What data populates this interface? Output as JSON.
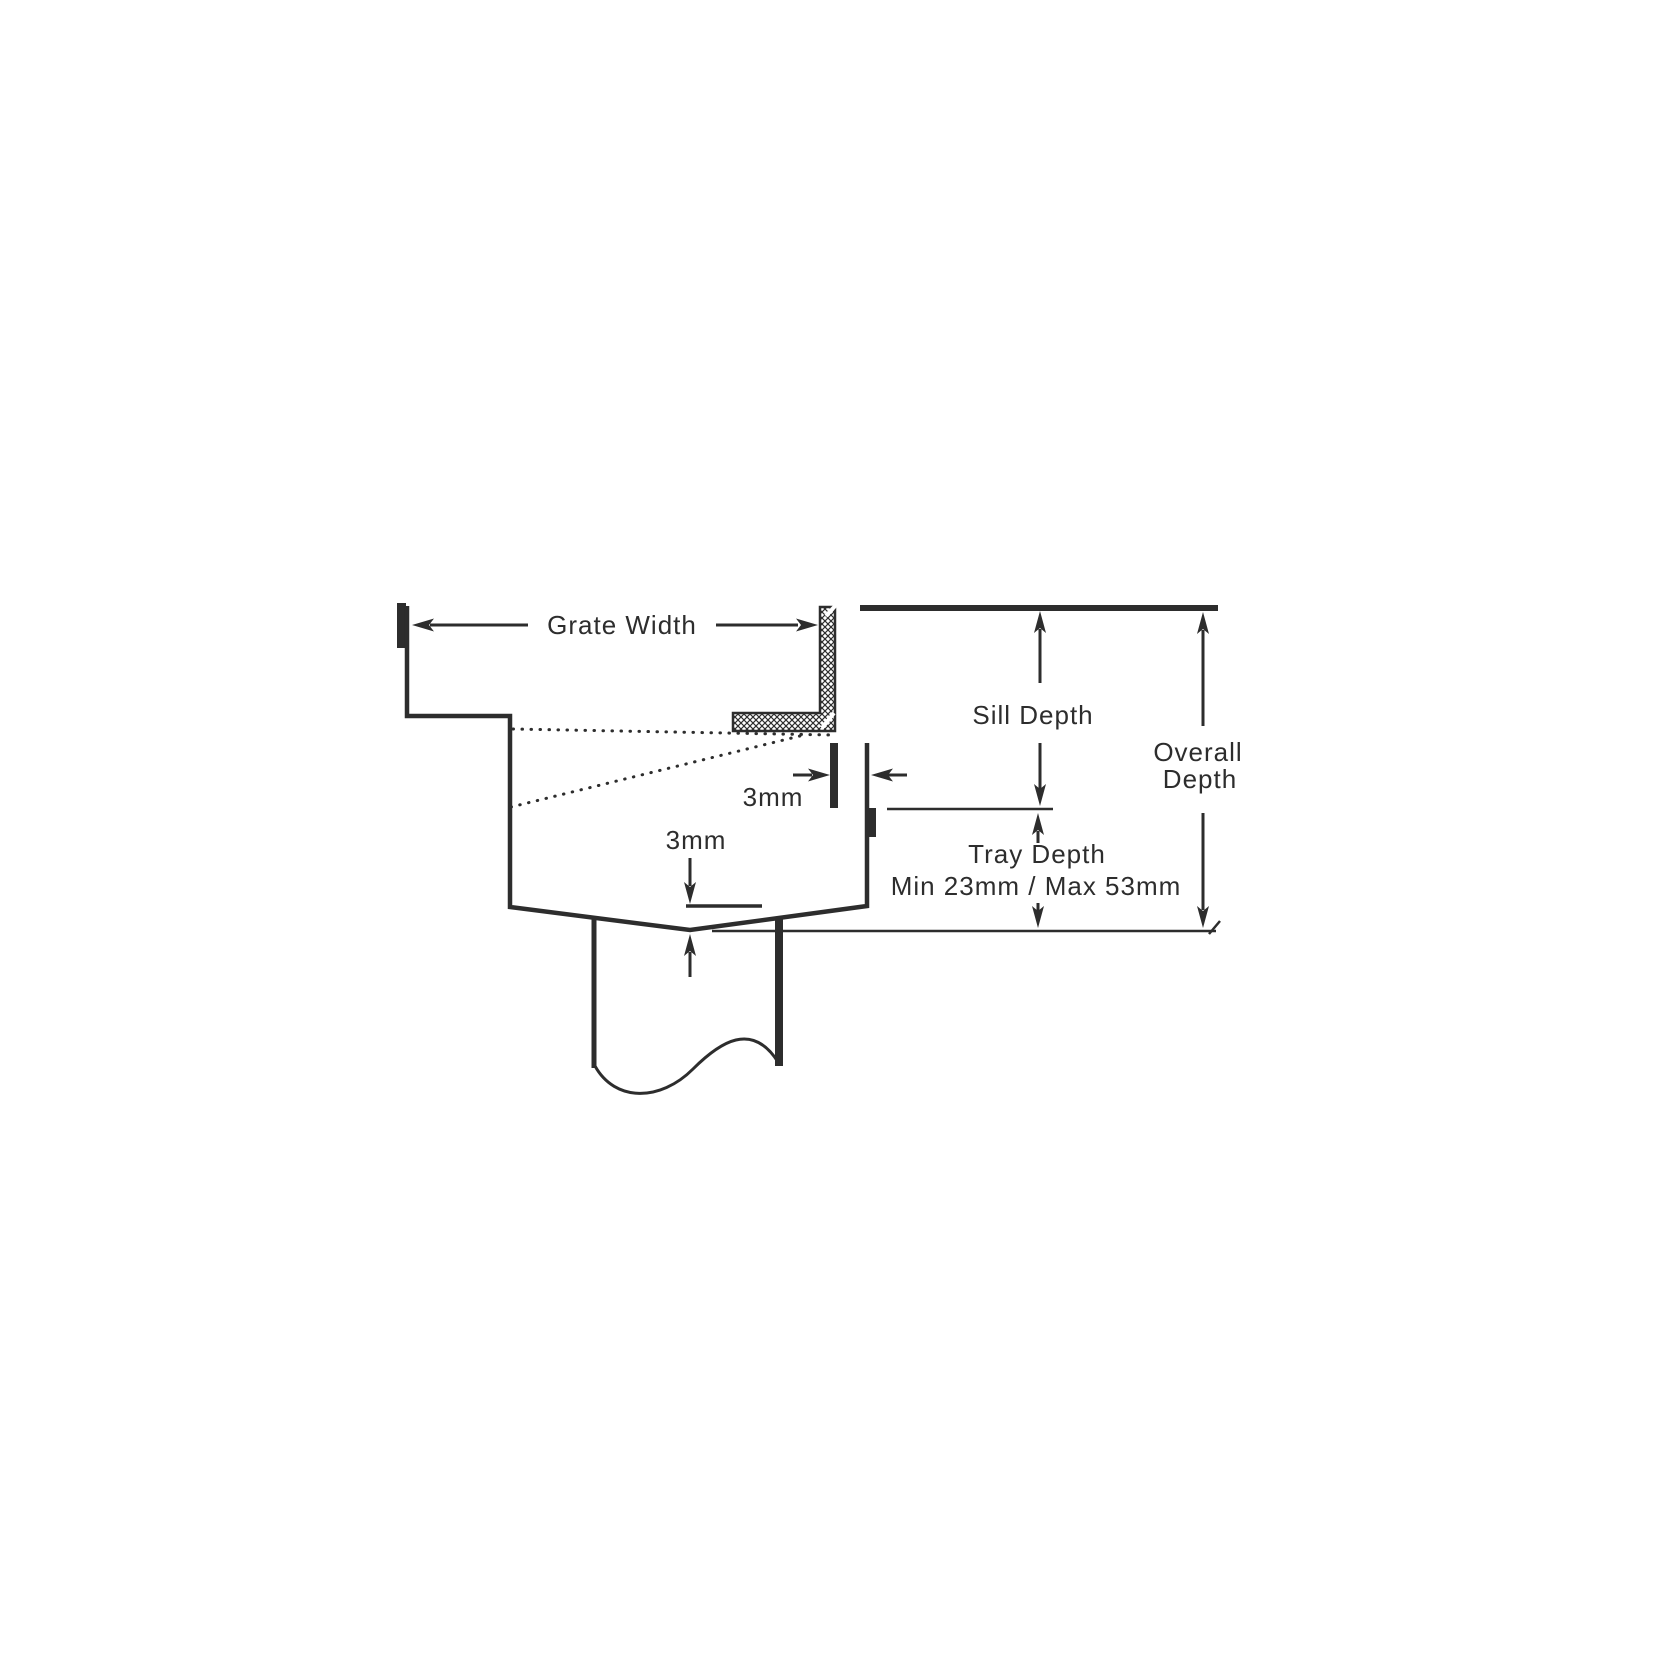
{
  "diagram": {
    "description": "Cross-section dimension drawing of a drainage grate tray with sill angle and outlet pipe",
    "labels": {
      "grate_width": "Grate Width",
      "sill_depth": "Sill Depth",
      "overall_line1": "Overall",
      "overall_line2": "Depth",
      "tray_depth": "Tray Depth",
      "tray_depth_range": "Min 23mm / Max 53mm",
      "gap_top": "3mm",
      "gap_bottom": "3mm"
    },
    "colors": {
      "ink": "#2d2d2d",
      "background": "#ffffff"
    }
  }
}
